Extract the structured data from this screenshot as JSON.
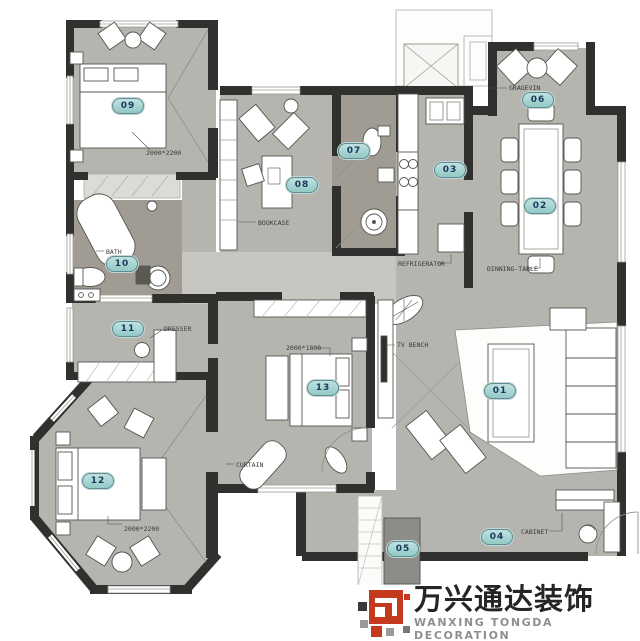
{
  "palette": {
    "floor": "#b5b4af",
    "floor_bath": "#a09c94",
    "floor_hall": "#c7c6c1",
    "floor_balcony": "#8e8c86",
    "wall": "#30302e",
    "pill_fill": "#9fd2cf",
    "pill_border": "#5d8d94",
    "pill_text": "#17395c",
    "logo_red": "#c53a1e",
    "logo_dark": "#252525",
    "logo_gray": "#8f8f8f"
  },
  "rooms": [
    {
      "num": "01",
      "x": 500,
      "y": 391
    },
    {
      "num": "02",
      "x": 540,
      "y": 206
    },
    {
      "num": "03",
      "x": 450,
      "y": 170
    },
    {
      "num": "04",
      "x": 497,
      "y": 537
    },
    {
      "num": "05",
      "x": 403,
      "y": 549
    },
    {
      "num": "06",
      "x": 538,
      "y": 100
    },
    {
      "num": "07",
      "x": 354,
      "y": 151
    },
    {
      "num": "08",
      "x": 302,
      "y": 185
    },
    {
      "num": "09",
      "x": 128,
      "y": 106
    },
    {
      "num": "10",
      "x": 122,
      "y": 264
    },
    {
      "num": "11",
      "x": 128,
      "y": 329
    },
    {
      "num": "12",
      "x": 98,
      "y": 481
    },
    {
      "num": "13",
      "x": 323,
      "y": 388
    }
  ],
  "annotations": [
    {
      "text": "2000*2200",
      "x": 146,
      "y": 149
    },
    {
      "text": "BOOKCASE",
      "x": 258,
      "y": 219
    },
    {
      "text": "GRAGEVIN",
      "x": 509,
      "y": 84
    },
    {
      "text": "REFRIGERATOR",
      "x": 398,
      "y": 260
    },
    {
      "text": "DINNING-TABLE",
      "x": 487,
      "y": 265
    },
    {
      "text": "BATH",
      "x": 106,
      "y": 248
    },
    {
      "text": "DRESSER",
      "x": 164,
      "y": 325
    },
    {
      "text": "2000*1800",
      "x": 286,
      "y": 344
    },
    {
      "text": "TV BENCH",
      "x": 397,
      "y": 341
    },
    {
      "text": "CURTAIN",
      "x": 236,
      "y": 461
    },
    {
      "text": "CABINET",
      "x": 521,
      "y": 528
    },
    {
      "text": "2000*2200",
      "x": 124,
      "y": 525
    }
  ],
  "logo": {
    "cn": "万兴通达装饰",
    "en": "WANXING TONGDA DECORATION"
  }
}
